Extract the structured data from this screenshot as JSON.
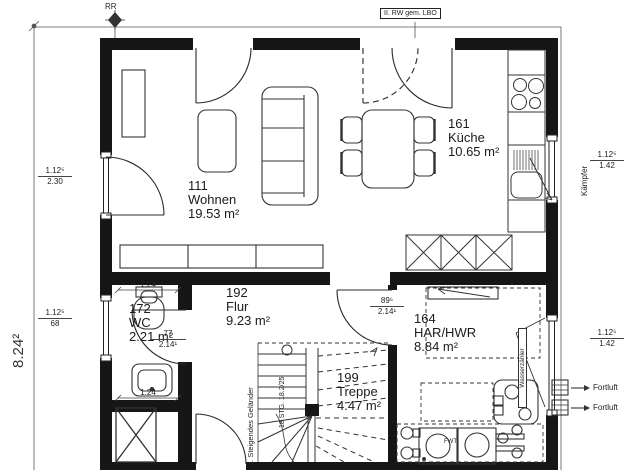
{
  "annotations": {
    "rr": "RR",
    "rw_box": "II. RW gem. LBO",
    "kaempfer": "Kämpfer",
    "wasserzaehler": "Wasserzähler",
    "fortluft_top": "Fortluft",
    "fortluft_bottom": "Fortluft",
    "gelaender": "2. Steigendes Geländer",
    "stufen": "18 STG. 18.2/25",
    "fwt": "FWT"
  },
  "rooms": [
    {
      "id": "111",
      "name": "Wohnen",
      "area": "19.53 m²"
    },
    {
      "id": "161",
      "name": "Küche",
      "area": "10.65 m²"
    },
    {
      "id": "192",
      "name": "Flur",
      "area": "9.23 m²"
    },
    {
      "id": "172",
      "name": "WC",
      "area": "2.21 m²"
    },
    {
      "id": "164",
      "name": "HAR/HWR",
      "area": "8.84 m²"
    },
    {
      "id": "199",
      "name": "Treppe",
      "area": "4.47 m²"
    }
  ],
  "dimensions": {
    "overall_height": "8.24²",
    "left_upper": {
      "top": "1.12⁵",
      "bottom": "2.30"
    },
    "left_lower": {
      "top": "1.12⁵",
      "bottom": "68"
    },
    "right_upper": {
      "top": "1.12⁵",
      "bottom": "1.42"
    },
    "right_lower": {
      "top": "1.12⁵",
      "bottom": "1.42"
    },
    "wc_top": "1.24",
    "wc_bottom": "1.24",
    "wc_door": {
      "top": "77",
      "bottom": "2.14¹"
    },
    "har_door": {
      "top": "89⁵",
      "bottom": "2.14¹"
    }
  },
  "colors": {
    "wall": "#161616",
    "line": "#2b2b2b",
    "background": "#ffffff"
  }
}
